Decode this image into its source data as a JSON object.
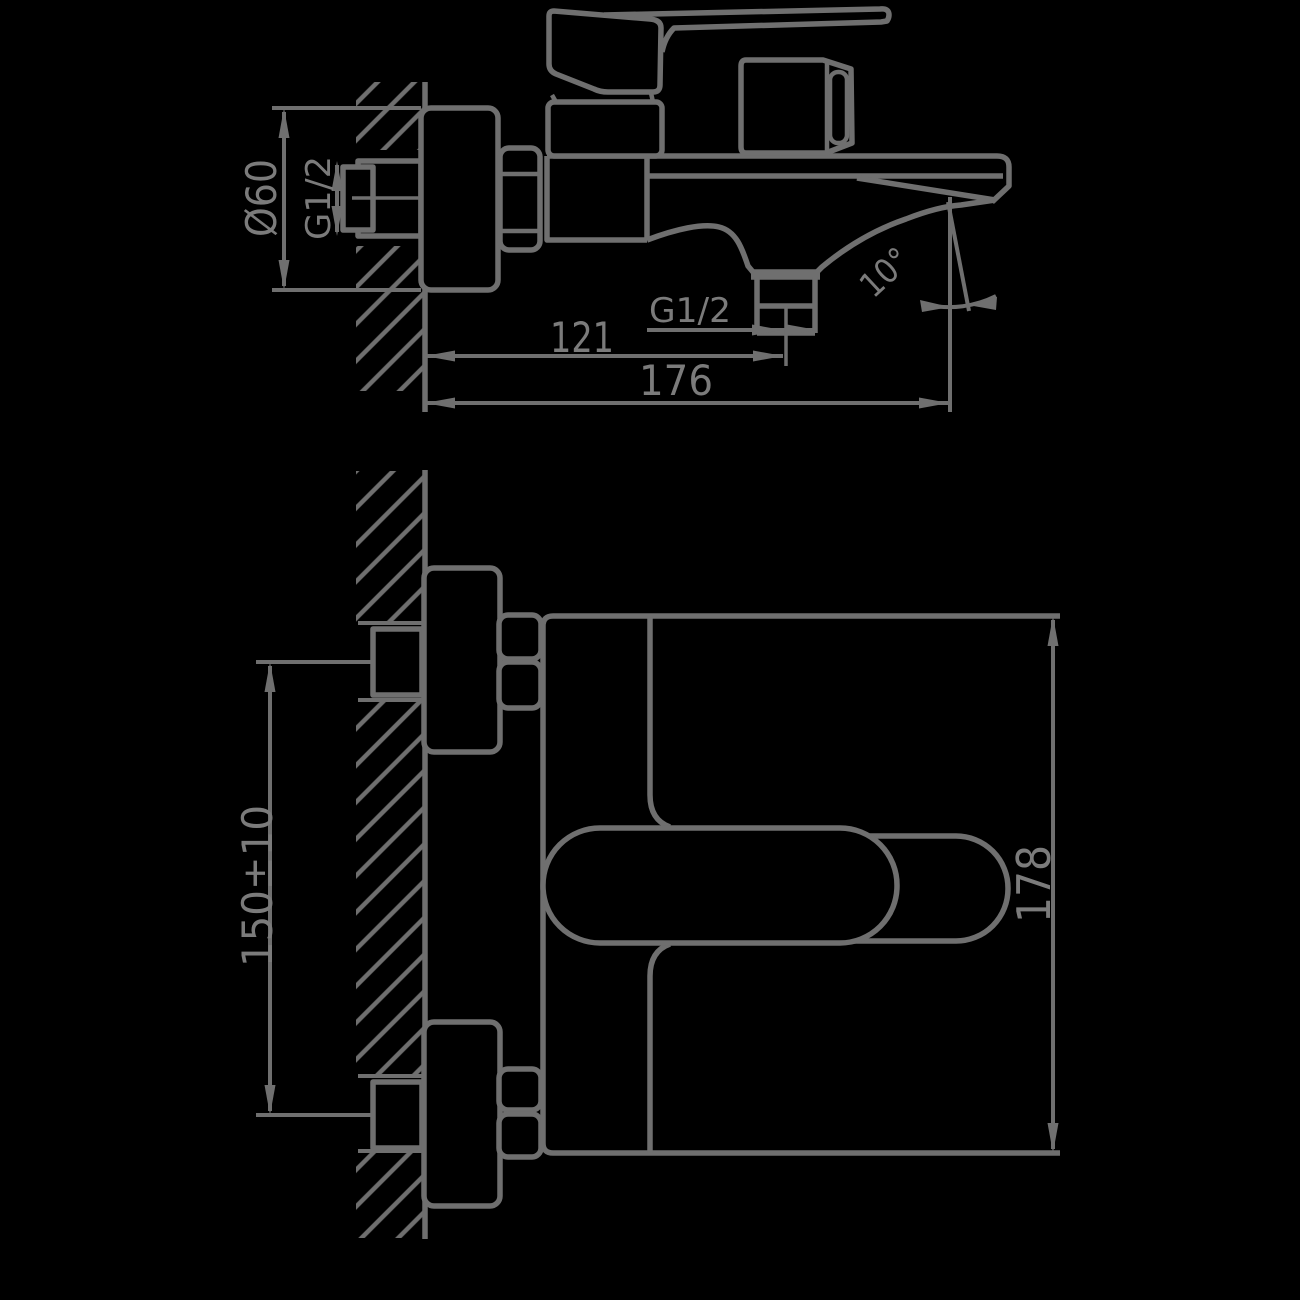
{
  "page": {
    "background": "#000000"
  },
  "drawing": {
    "line_color": "#6f6f6f",
    "text_color": "#7b7b7b",
    "side_view": {
      "labels": {
        "escutcheon_diameter": "Ø60",
        "wall_connection_thread": "G1/2",
        "wall_to_outlet_center": "121",
        "overall_depth": "176",
        "outlet_thread": "G1/2",
        "spout_angle": "10°"
      }
    },
    "front_view": {
      "labels": {
        "inlet_centers": "150±10",
        "overall_width": "178"
      }
    }
  }
}
